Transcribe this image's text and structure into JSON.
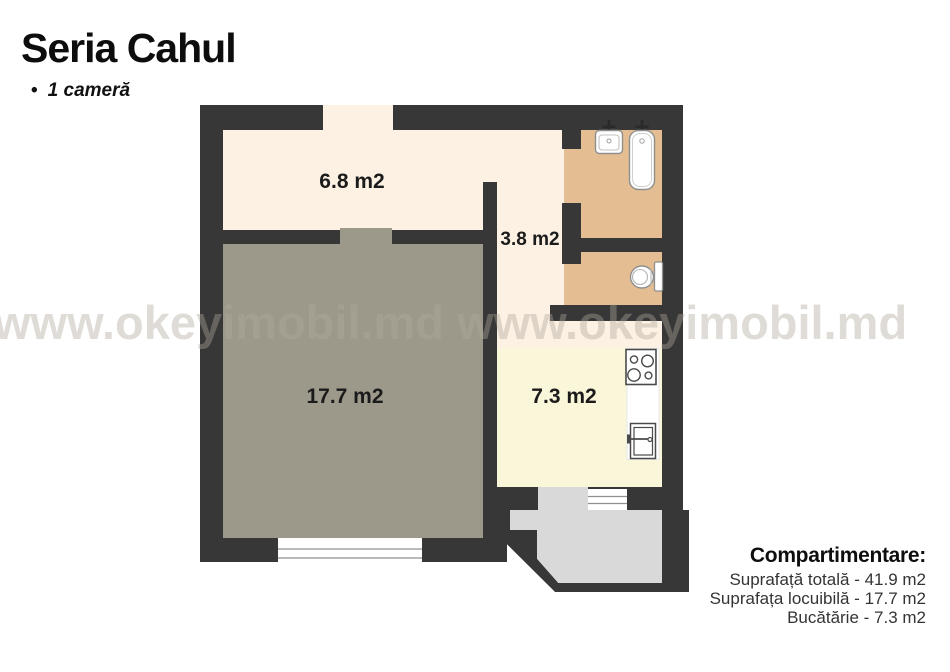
{
  "header": {
    "title": "Seria Cahul",
    "bullet": "•",
    "subtitle": "1 cameră"
  },
  "watermark": {
    "text": "www.okeyimobil.md www.okeyimobil.md"
  },
  "floor_plan": {
    "rooms": [
      {
        "id": "hallway",
        "label": "6.8 m2"
      },
      {
        "id": "corridor",
        "label": "3.8 m2"
      },
      {
        "id": "living-room",
        "label": "17.7 m2"
      },
      {
        "id": "kitchen",
        "label": "7.3 m2"
      },
      {
        "id": "bathroom",
        "label": ""
      },
      {
        "id": "toilet",
        "label": ""
      },
      {
        "id": "balcony",
        "label": ""
      }
    ],
    "fixtures": [
      "bath-sink",
      "bathtub",
      "toilet-bowl",
      "stove",
      "kitchen-sink"
    ]
  },
  "legend": {
    "title": "Compartimentare:",
    "lines": [
      "Suprafață totală - 41.9 m2",
      "Suprafața locuibilă - 17.7 m2",
      "Bucătărie - 7.3 m2"
    ]
  },
  "colors": {
    "wall": "#373737",
    "hallway": "#fcf1e3",
    "living": "#9c998a",
    "wet_rooms": "#e4be92",
    "kitchen": "#faf6d9",
    "balcony": "#d9d9d9",
    "watermark": "#e6e3de",
    "text": "#0d0d0d"
  }
}
